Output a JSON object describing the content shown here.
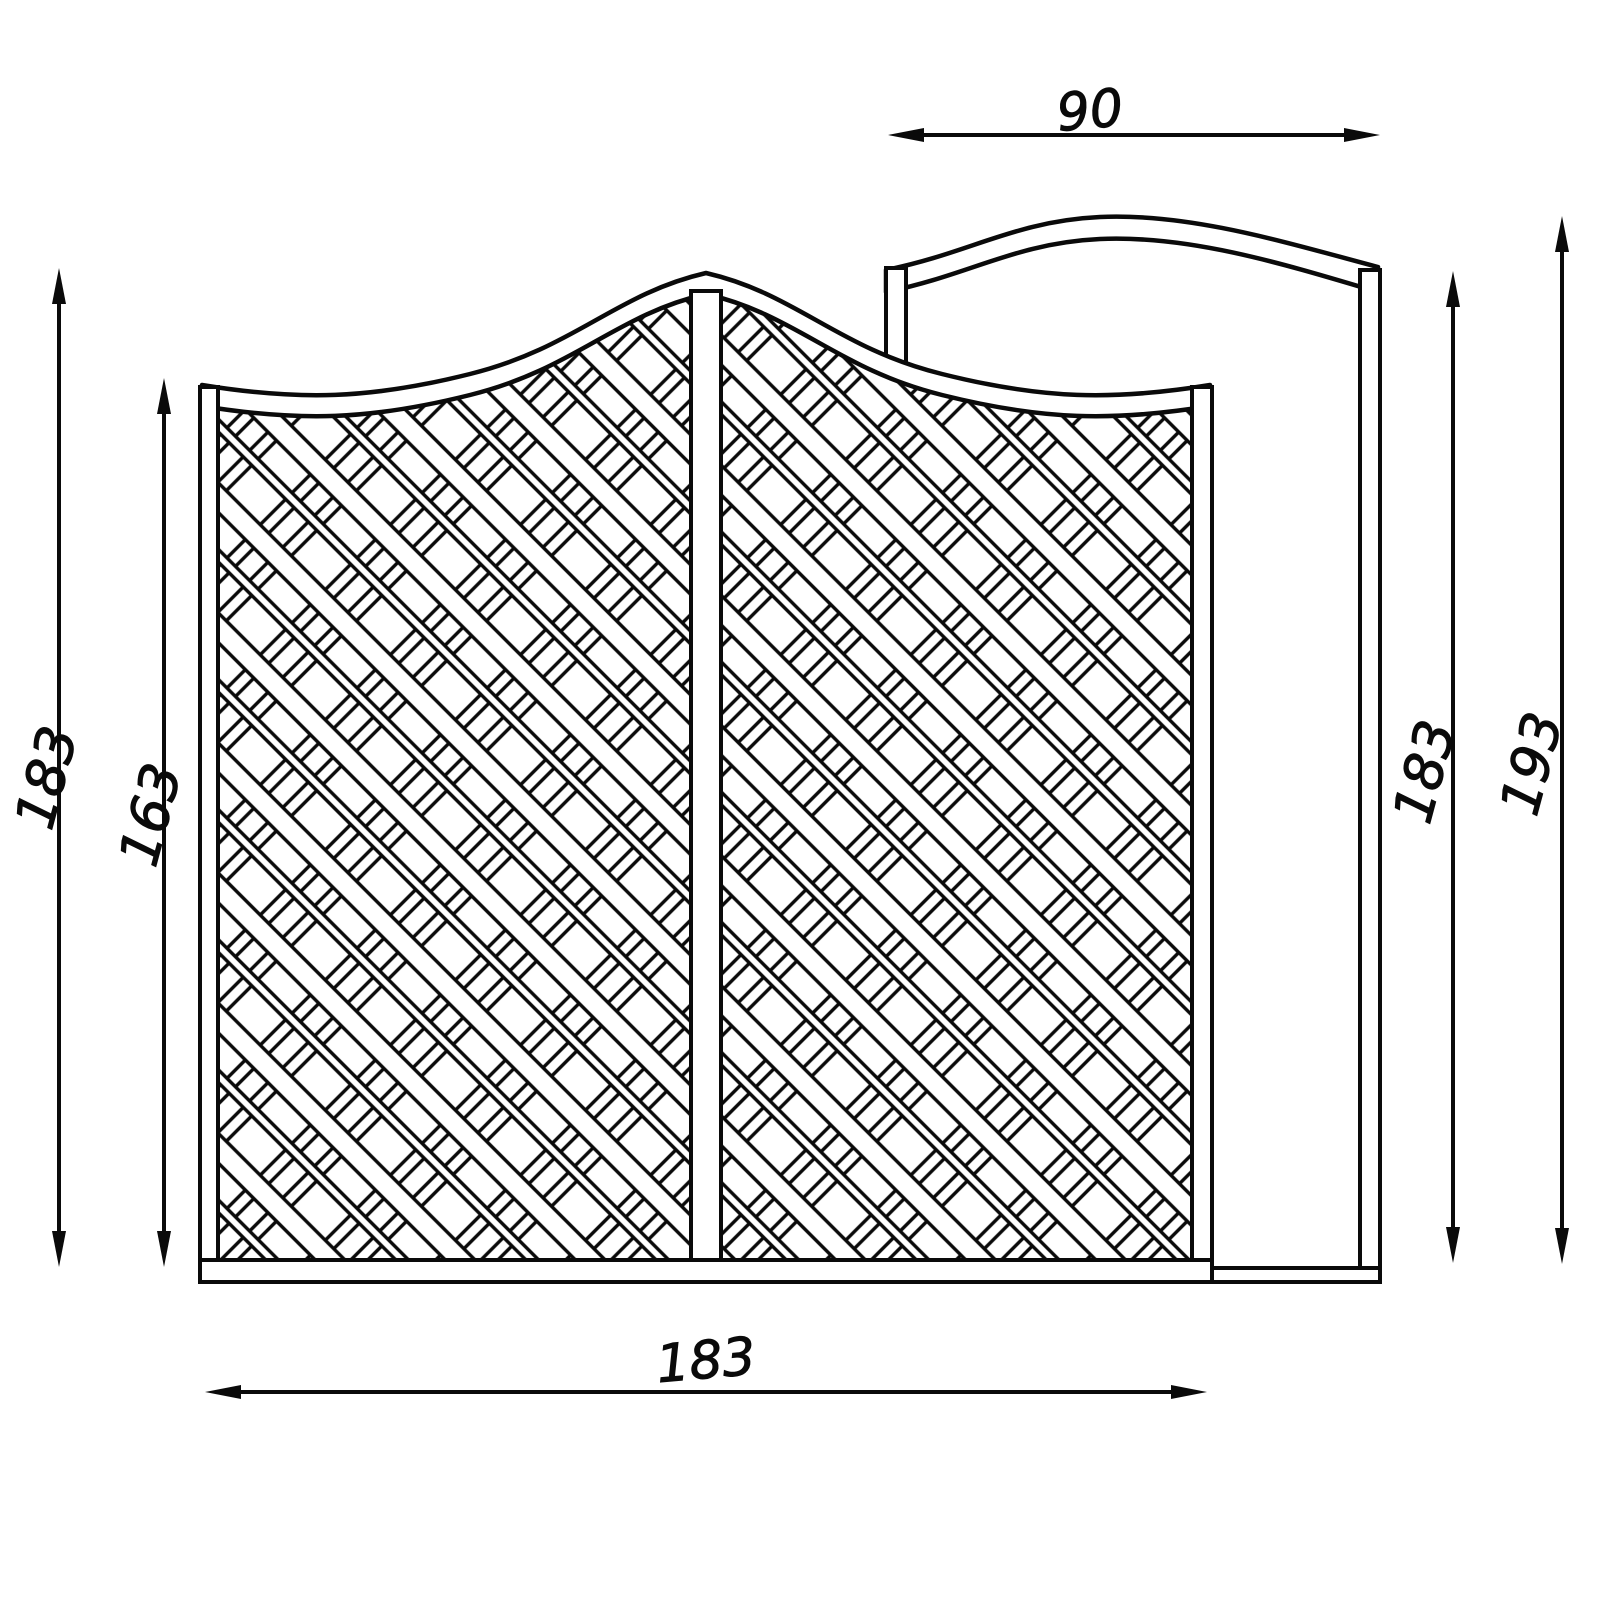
{
  "drawing": {
    "type": "fence-panel-technical-drawing",
    "colors": {
      "line": "#0a0a0a",
      "background": "#ffffff"
    },
    "dimensions": {
      "top_width": {
        "value": "90",
        "orientation": "horizontal",
        "measures": "side panel width"
      },
      "bottom_width": {
        "value": "183",
        "orientation": "horizontal",
        "measures": "main panel width"
      },
      "left_outer_height": {
        "value": "183",
        "orientation": "vertical",
        "measures": "main panel overall height"
      },
      "left_inner_height": {
        "value": "163",
        "orientation": "vertical",
        "measures": "main panel lattice height"
      },
      "right_inner_height": {
        "value": "183",
        "orientation": "vertical",
        "measures": "side panel shoulder height"
      },
      "right_outer_height": {
        "value": "193",
        "orientation": "vertical",
        "measures": "side panel peak height"
      }
    }
  }
}
